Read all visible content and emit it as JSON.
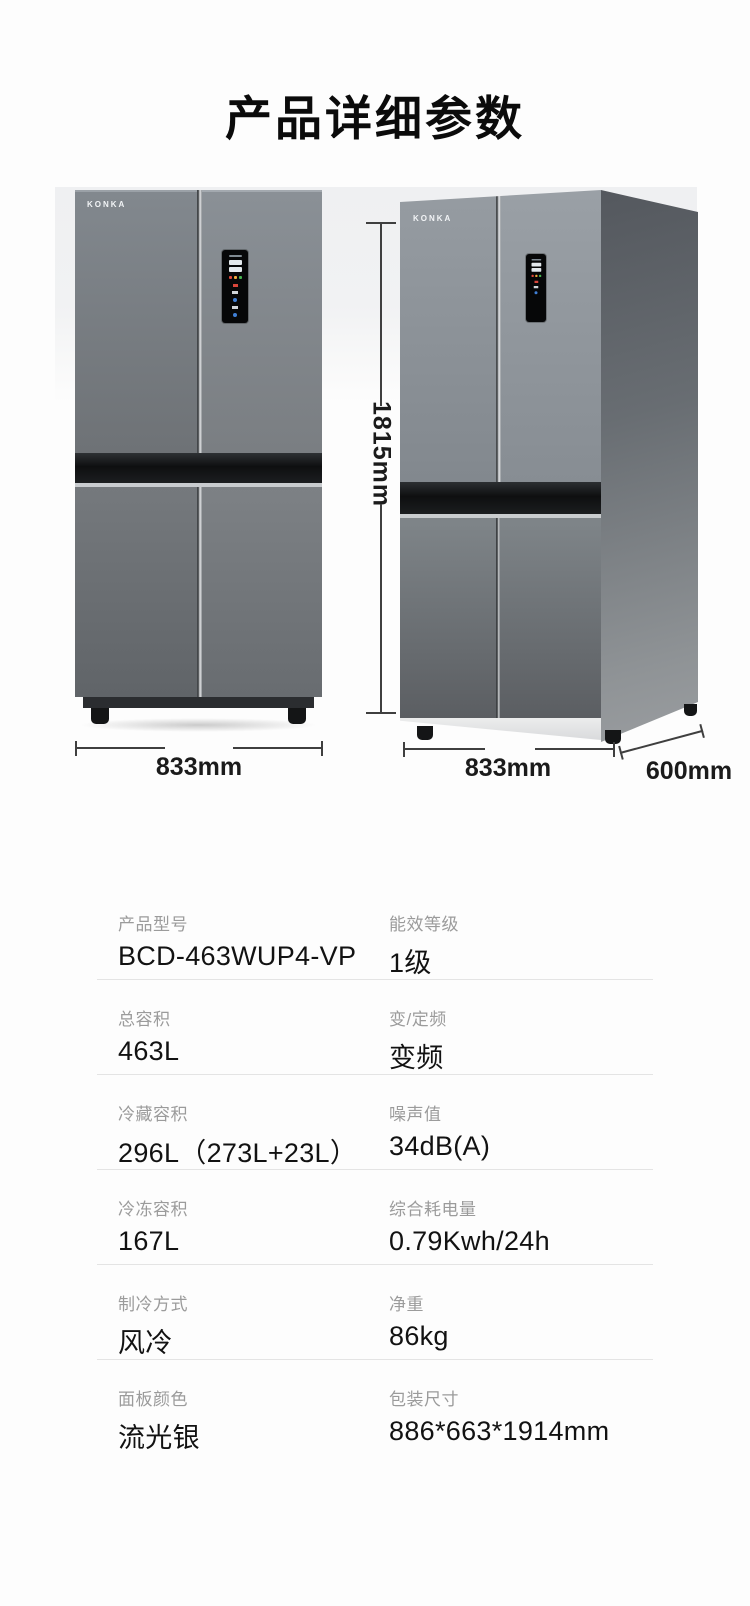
{
  "page": {
    "title": "产品详细参数"
  },
  "photos": {
    "brand": "KONKA",
    "front": {
      "width_label": "833mm"
    },
    "angled": {
      "height_label": "1815mm",
      "width_label": "833mm",
      "depth_label": "600mm"
    }
  },
  "specs": {
    "rows": [
      {
        "left": {
          "label": "产品型号",
          "value": "BCD-463WUP4-VP"
        },
        "right": {
          "label": "能效等级",
          "value": "1级"
        }
      },
      {
        "left": {
          "label": "总容积",
          "value": "463L"
        },
        "right": {
          "label": "变/定频",
          "value": "变频"
        }
      },
      {
        "left": {
          "label": "冷藏容积",
          "value": "296L（273L+23L）"
        },
        "right": {
          "label": "噪声值",
          "value": "34dB(A)"
        }
      },
      {
        "left": {
          "label": "冷冻容积",
          "value": "167L"
        },
        "right": {
          "label": "综合耗电量",
          "value": "0.79Kwh/24h"
        }
      },
      {
        "left": {
          "label": "制冷方式",
          "value": "风冷"
        },
        "right": {
          "label": "净重",
          "value": "86kg"
        }
      },
      {
        "left": {
          "label": "面板颜色",
          "value": "流光银"
        },
        "right": {
          "label": "包装尺寸",
          "value": "886*663*1914mm"
        }
      }
    ]
  },
  "colors": {
    "label_text": "#9b9b9b",
    "value_text": "#121212",
    "divider": "#e4e4e4",
    "dimension_text": "#1b1b1b",
    "fridge_gray": "#7d838a",
    "panel_black": "#060708",
    "indicator_red": "#d8453a",
    "indicator_orange": "#f2a93b",
    "indicator_green": "#46b450",
    "indicator_blue": "#3f7fd6"
  }
}
